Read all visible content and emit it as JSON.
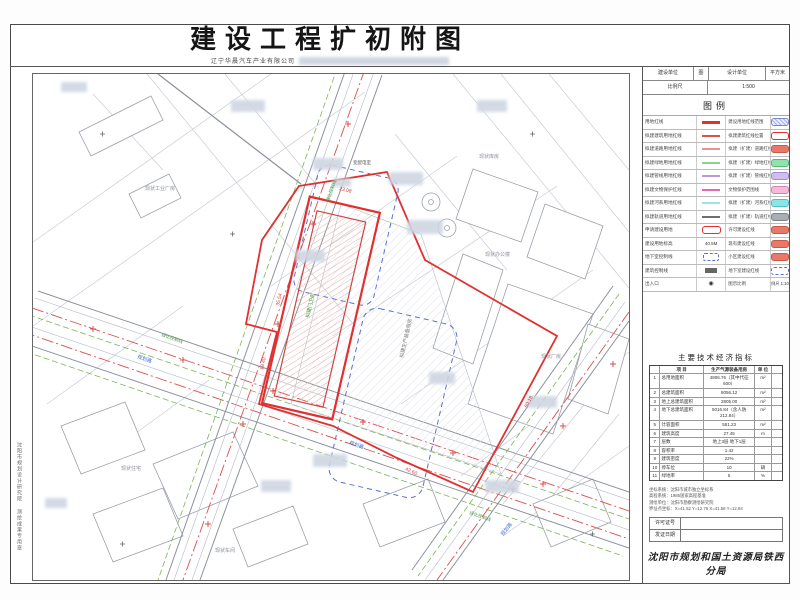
{
  "title": {
    "main": "建设工程扩初附图",
    "subtitle": "辽宁华晨汽车产业有限公司"
  },
  "titleblock": {
    "cells": [
      "建设单位",
      "图",
      "设计单位",
      "平方米"
    ],
    "row2": [
      "比例尺",
      "1:500"
    ]
  },
  "legend": {
    "heading": "图例",
    "rows": [
      {
        "l": "用地红线",
        "sym": {
          "type": "line",
          "color": "#e03030",
          "w": 3
        },
        "r": "建设用地红线范围",
        "sw": {
          "type": "hatch"
        }
      },
      {
        "l": "拟建建筑用地红线",
        "sym": {
          "type": "line",
          "color": "#e05050",
          "w": 2
        },
        "r": "拟建建筑红线位置",
        "sw": {
          "type": "obox",
          "color": "#e03030"
        }
      },
      {
        "l": "拟建道路用地红线",
        "sym": {
          "type": "line",
          "color": "#f09090",
          "w": 2
        },
        "r": "拟建（扩建）道路红线",
        "sw": {
          "type": "fill",
          "color": "#e8796a",
          "border": "#c85a4a"
        }
      },
      {
        "l": "拟建绿地用地红线",
        "sym": {
          "type": "line",
          "color": "#8fd08f",
          "w": 2
        },
        "r": "拟建（扩建）绿地红线",
        "sw": {
          "type": "fill",
          "color": "#92e2ac",
          "border": "#5cb87a"
        }
      },
      {
        "l": "拟建管线用地红线",
        "sym": {
          "type": "line",
          "color": "#b89ad8",
          "w": 2
        },
        "r": "拟建（扩建）管线红线",
        "sw": {
          "type": "fill",
          "color": "#d0bcee",
          "border": "#a48cd0"
        }
      },
      {
        "l": "拟建文物保护红线",
        "sym": {
          "type": "line",
          "color": "#e06aaa",
          "w": 2
        },
        "r": "文物保护范围线",
        "sw": {
          "type": "fill",
          "color": "#f4bada",
          "border": "#d286b4"
        }
      },
      {
        "l": "拟建河系用地红线",
        "sym": {
          "type": "line",
          "color": "#9ae4e4",
          "w": 2
        },
        "r": "拟建（扩建）河系红线",
        "sw": {
          "type": "fill",
          "color": "#88e6e6",
          "border": "#55c0c0"
        }
      },
      {
        "l": "拟建轨道用地红线",
        "sym": {
          "type": "line",
          "color": "#6e6e6e",
          "w": 2
        },
        "r": "拟建（扩建）轨道红线",
        "sw": {
          "type": "fill",
          "color": "#a9aeb5",
          "border": "#7d838c"
        }
      },
      {
        "l": "申请建设用地",
        "sym": {
          "type": "obox",
          "color": "#e03030"
        },
        "r": "许可建设红线",
        "sw": {
          "type": "fill",
          "color": "#e8796a",
          "border": "#c85a4a"
        }
      },
      {
        "l": "建设用地标高",
        "sym": {
          "type": "text",
          "text": "40.5M"
        },
        "r": "现有建设红线",
        "sw": {
          "type": "fill",
          "color": "#e8796a",
          "border": "#c85a4a"
        }
      },
      {
        "l": "地下室控制线",
        "sym": {
          "type": "dbox",
          "color": "#5b6fd4"
        },
        "r": "小区建设红线",
        "sw": {
          "type": "fill",
          "color": "#e8796a",
          "border": "#c85a4a"
        }
      },
      {
        "l": "建筑控制线",
        "sym": {
          "type": "sbox",
          "color": "#666"
        },
        "r": "地下室建设红线",
        "sw": {
          "type": "dash"
        }
      },
      {
        "l": "出入口",
        "sym": {
          "type": "glyph",
          "text": "◉"
        },
        "r": "图示比例",
        "sw": {
          "type": "text",
          "text": "比例尺 1:1000"
        }
      }
    ]
  },
  "indicators": {
    "title": "主要技术经济指标",
    "header": {
      "n": "",
      "name": "项  目",
      "value": "生产气源装备用房",
      "unit": "单 位",
      "x": ""
    },
    "rows": [
      {
        "n": "1",
        "name": "总用地面积",
        "value": "4806.76（其中代征 600）",
        "unit": "m²",
        "x": ""
      },
      {
        "n": "2",
        "name": "总建筑面积",
        "value": "8056.12",
        "unit": "m²",
        "x": ""
      },
      {
        "n": "3",
        "name": "地上总建筑面积",
        "value": "2805.00",
        "unit": "m²",
        "x": ""
      },
      {
        "n": "4",
        "name": "地下总建筑面积",
        "value": "5016.84（含人防 212.84）",
        "unit": "m²",
        "x": ""
      },
      {
        "n": "5",
        "name": "计容面积",
        "value": "551.23",
        "unit": "m²",
        "x": ""
      },
      {
        "n": "6",
        "name": "建筑高度",
        "value": "27.45",
        "unit": "m",
        "x": ""
      },
      {
        "n": "7",
        "name": "层数",
        "value": "地上3层 地下1层",
        "unit": "",
        "x": ""
      },
      {
        "n": "8",
        "name": "容积率",
        "value": "1.42",
        "unit": "",
        "x": ""
      },
      {
        "n": "9",
        "name": "建筑密度",
        "value": "22%",
        "unit": "",
        "x": ""
      },
      {
        "n": "10",
        "name": "停车位",
        "value": "10",
        "unit": "辆",
        "x": ""
      },
      {
        "n": "11",
        "name": "绿地率",
        "value": "5",
        "unit": "%",
        "x": ""
      }
    ]
  },
  "notes": [
    "坐标系统：沈阳市城市独立坐标系",
    "高程系统：1985国家高程基准",
    "测绘单位：沈阳市勘察测绘研究院",
    "界址点坐标：X=41.52  Y=12.76  X=41.58  Y=12.84"
  ],
  "fields": [
    {
      "label": "许可证号",
      "value": ""
    },
    {
      "label": "发证日期",
      "value": ""
    }
  ],
  "authority": "沈阳市规划和国土资源局铁西分局",
  "margin_text": [
    "沈阳市规划设计研究院",
    "测绘成果专用章"
  ],
  "map": {
    "labels": [
      {
        "t": "35.54",
        "x": 246,
        "y": 232,
        "r": -77,
        "c": "#d04040",
        "s": 5
      },
      {
        "t": "23.08",
        "x": 306,
        "y": 116,
        "r": 13,
        "c": "#d04040",
        "s": 5
      },
      {
        "t": "60.18",
        "x": 494,
        "y": 334,
        "r": -62,
        "c": "#d04040",
        "s": 5
      },
      {
        "t": "42.60",
        "x": 372,
        "y": 396,
        "r": 25,
        "c": "#d04040",
        "s": 5
      },
      {
        "t": "18.40",
        "x": 230,
        "y": 296,
        "r": -77,
        "c": "#d04040",
        "s": 5
      },
      {
        "t": "拟建门卫房",
        "x": 276,
        "y": 244,
        "r": -77,
        "c": "#3a9a3a",
        "s": 5
      },
      {
        "t": "拟建生产装备用房",
        "x": 370,
        "y": 284,
        "r": -77,
        "c": "#777777",
        "s": 5
      },
      {
        "t": "变配电室",
        "x": 320,
        "y": 90,
        "r": 0,
        "c": "#555555",
        "s": 4.5
      },
      {
        "t": "现状工业厂房",
        "x": 112,
        "y": 116,
        "r": 0,
        "c": "#8a8f99",
        "s": 5
      },
      {
        "t": "现状库房",
        "x": 446,
        "y": 84,
        "r": 0,
        "c": "#8a8f99",
        "s": 5
      },
      {
        "t": "现状办公楼",
        "x": 452,
        "y": 182,
        "r": 0,
        "c": "#8a8f99",
        "s": 5
      },
      {
        "t": "现状厂房",
        "x": 508,
        "y": 284,
        "r": 0,
        "c": "#8a8f99",
        "s": 5
      },
      {
        "t": "现状住宅",
        "x": 88,
        "y": 396,
        "r": 0,
        "c": "#8a8f99",
        "s": 5
      },
      {
        "t": "现状车间",
        "x": 182,
        "y": 478,
        "r": 0,
        "c": "#8a8f99",
        "s": 5
      },
      {
        "t": "规划路",
        "x": 104,
        "y": 284,
        "r": 19,
        "c": "#3b6fd4",
        "s": 5
      },
      {
        "t": "规划路",
        "x": 316,
        "y": 370,
        "r": 19,
        "c": "#3b6fd4",
        "s": 5
      },
      {
        "t": "规划路",
        "x": 470,
        "y": 462,
        "r": -51,
        "c": "#3b6fd4",
        "s": 5
      },
      {
        "t": "绿化控制线",
        "x": 128,
        "y": 262,
        "r": 19,
        "c": "#4a9a4a",
        "s": 4.5
      },
      {
        "t": "绿化控制线",
        "x": 436,
        "y": 440,
        "r": 19,
        "c": "#4a9a4a",
        "s": 4.5
      },
      {
        "t": "绿化控制线",
        "x": 296,
        "y": 128,
        "r": -71,
        "c": "#4a9a4a",
        "s": 4.5
      }
    ],
    "redactions": [
      {
        "x": 198,
        "y": 26,
        "w": 34,
        "h": 12
      },
      {
        "x": 444,
        "y": 26,
        "w": 30,
        "h": 12
      },
      {
        "x": 280,
        "y": 84,
        "w": 30,
        "h": 12
      },
      {
        "x": 356,
        "y": 98,
        "w": 34,
        "h": 13
      },
      {
        "x": 300,
        "y": 104,
        "w": 18,
        "h": 9
      },
      {
        "x": 374,
        "y": 146,
        "w": 36,
        "h": 14
      },
      {
        "x": 262,
        "y": 176,
        "w": 30,
        "h": 12
      },
      {
        "x": 396,
        "y": 298,
        "w": 26,
        "h": 12
      },
      {
        "x": 280,
        "y": 380,
        "w": 34,
        "h": 13
      },
      {
        "x": 228,
        "y": 406,
        "w": 30,
        "h": 12
      },
      {
        "x": 452,
        "y": 406,
        "w": 34,
        "h": 13
      },
      {
        "x": 494,
        "y": 322,
        "w": 30,
        "h": 12
      },
      {
        "x": 12,
        "y": 424,
        "w": 22,
        "h": 10
      },
      {
        "x": 28,
        "y": 8,
        "w": 26,
        "h": 10
      }
    ]
  }
}
